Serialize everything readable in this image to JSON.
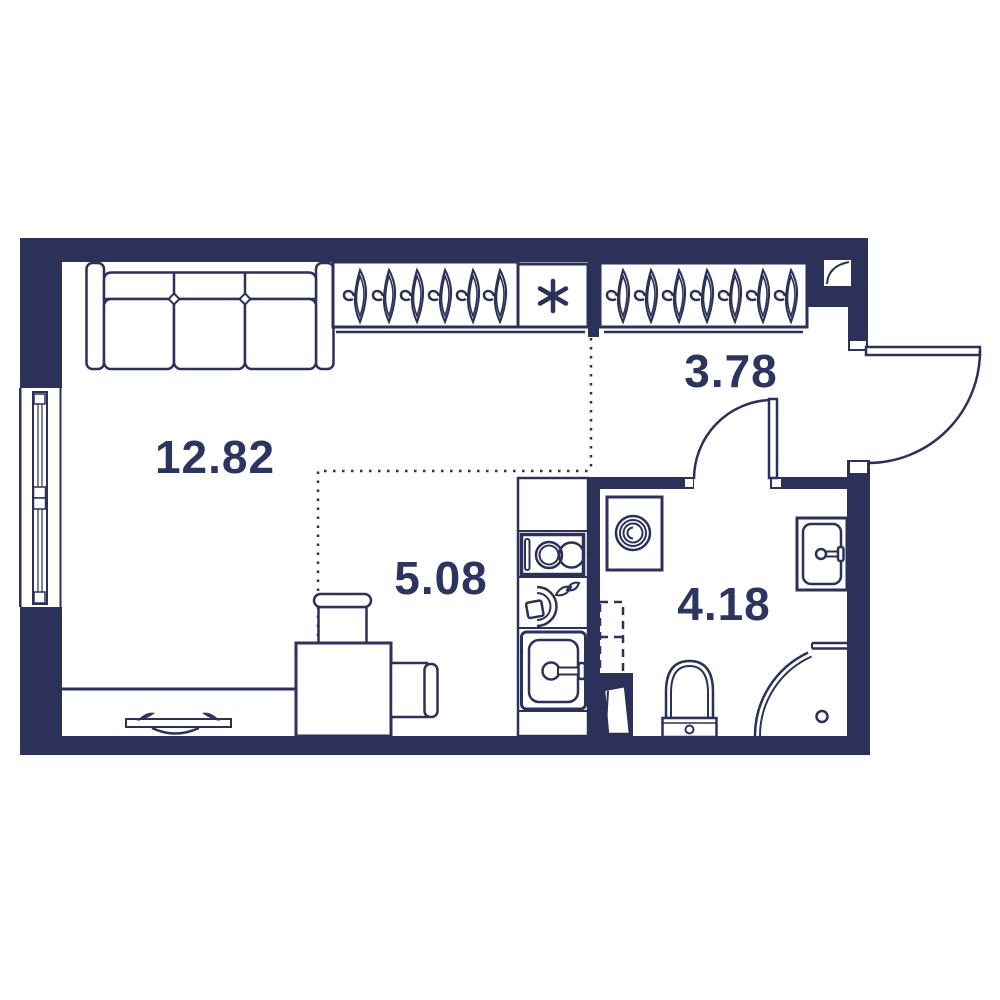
{
  "title": "Studio apartment floor plan",
  "palette": {
    "wall": "#2b3158",
    "line": "#2b3158",
    "label": "#2b3560",
    "background": "#ffffff"
  },
  "floor_plan": {
    "labels": {
      "living": "12.82",
      "kitchen": "5.08",
      "hallway": "3.78",
      "bathroom": "4.18"
    },
    "fixtures": [
      "sofa",
      "window",
      "wardrobe-hangers-left",
      "refrigerator-snowflake",
      "wardrobe-hangers-right",
      "vent-duct",
      "entry-door",
      "interior-door",
      "kitchen-counter",
      "stove",
      "kettle",
      "kitchen-sink",
      "dining-table",
      "chair-top",
      "chair-right",
      "radiator",
      "washing-machine",
      "plumbing-shaft",
      "shaft-access-door",
      "wash-basin",
      "toilet",
      "shower"
    ]
  }
}
